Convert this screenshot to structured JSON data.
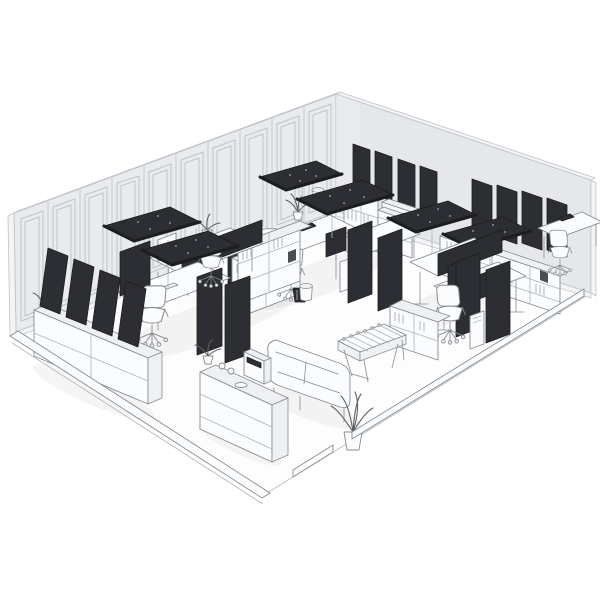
{
  "scene": {
    "subject": "Isometric 3D rendering of an open-plan office interior with dark acoustic panels",
    "style": "grayscale architectural render, white background, cutaway room view",
    "room": {
      "visible_walls": 2,
      "left_wall": "classical paneled wall, 10 molded bays",
      "right_wall": "plain wall with wall-mounted acoustic panels",
      "floor": "open white floor, cutaway front edges with baseboard stubs"
    },
    "colors": {
      "bg": "#ffffff",
      "floor": "#fdfdfe",
      "wall": "#e9ebee",
      "wall2": "#e5e7ea",
      "wall_cap": "#f3f4f6",
      "wall_line": "#bfc3c8",
      "pilaster": "#d3d6da",
      "ink": "#878c92",
      "ink_light": "#b0b4b9",
      "furn": "#fbfcfd",
      "furn_shade": "#eef0f2",
      "panel_dark": "#2d2e33",
      "panel_edge": "#1c1d21",
      "panel_dot": "#888b91",
      "book_dark": "#4a4d52",
      "plant": "#5d6166"
    },
    "inventory": {
      "ceiling_acoustic_canopies": 6,
      "wall_acoustic_panels_right": 8,
      "leaning_acoustic_panels_left": 4,
      "freestanding_acoustic_partitions": 5,
      "desk_clusters": 3,
      "desks": 7,
      "office_chairs": 7,
      "monitors_and_laptops": 9,
      "shelving_units": 5,
      "sideboards": 1,
      "sofas": 1,
      "foosball_tables": 1,
      "potted_plants": 4,
      "coffee_counters": 1,
      "coffee_machines": 1,
      "waste_bins": 4,
      "printers": 1
    }
  }
}
